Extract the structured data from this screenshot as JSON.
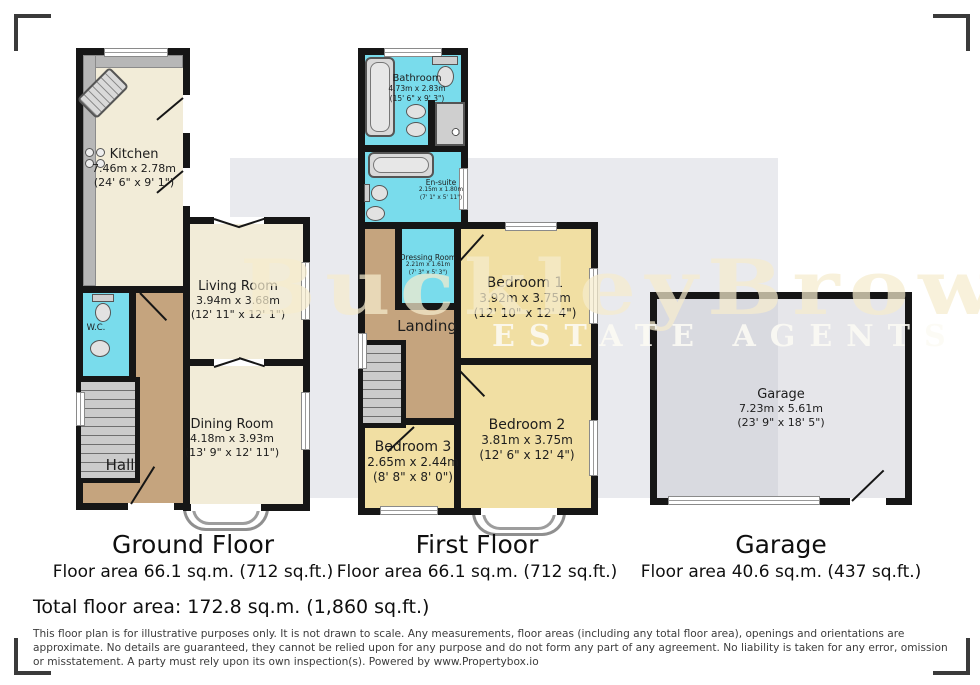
{
  "watermark": {
    "name": "BuckleyBrown",
    "tagline": "ESTATE AGENTS"
  },
  "colors": {
    "wall": "#161616",
    "wet_room": "#79dcec",
    "reception": "#f2ecd8",
    "bedroom": "#f1dfa3",
    "hall": "#c5a47e",
    "garage": "#e4e4e8",
    "watermark_text": "#f0e5c4"
  },
  "rooms": {
    "kitchen": {
      "name": "Kitchen",
      "metric": "7.46m x 2.78m",
      "imperial": "(24' 6\" x 9' 1\")"
    },
    "living": {
      "name": "Living Room",
      "metric": "3.94m x 3.68m",
      "imperial": "(12' 11\" x 12' 1\")"
    },
    "dining": {
      "name": "Dining Room",
      "metric": "4.18m x 3.93m",
      "imperial": "(13' 9\" x 12' 11\")"
    },
    "hall": {
      "name": "Hall"
    },
    "wc": {
      "name": "W.C."
    },
    "bathroom": {
      "name": "Bathroom",
      "metric": "4.73m x 2.83m",
      "imperial": "(15' 6\" x 9' 3\")"
    },
    "ensuite": {
      "name": "En-suite",
      "metric": "2.15m x 1.80m",
      "imperial": "(7' 1\" x 5' 11\")"
    },
    "dressing": {
      "name": "Dressing Room",
      "metric": "2.21m x 1.61m",
      "imperial": "(7' 3\" x 5' 3\")"
    },
    "landing": {
      "name": "Landing"
    },
    "bedroom1": {
      "name": "Bedroom 1",
      "metric": "3.92m x 3.75m",
      "imperial": "(12' 10\" x 12' 4\")"
    },
    "bedroom2": {
      "name": "Bedroom 2",
      "metric": "3.81m x 3.75m",
      "imperial": "(12' 6\" x 12' 4\")"
    },
    "bedroom3": {
      "name": "Bedroom 3",
      "metric": "2.65m x 2.44m",
      "imperial": "(8' 8\" x 8' 0\")"
    },
    "garage": {
      "name": "Garage",
      "metric": "7.23m x 5.61m",
      "imperial": "(23' 9\" x 18' 5\")"
    }
  },
  "floors": {
    "ground": {
      "title": "Ground Floor",
      "area": "Floor area 66.1 sq.m. (712 sq.ft.)"
    },
    "first": {
      "title": "First Floor",
      "area": "Floor area 66.1 sq.m. (712 sq.ft.)"
    },
    "garage": {
      "title": "Garage",
      "area": "Floor area 40.6 sq.m. (437 sq.ft.)"
    }
  },
  "footer": {
    "total": "Total floor area: 172.8 sq.m. (1,860 sq.ft.)",
    "disclaimer": "This floor plan is for illustrative purposes only. It is not drawn to scale. Any measurements, floor areas (including any total floor area), openings and orientations are approximate. No details are guaranteed, they cannot be relied upon for any purpose and do not form any part of any agreement. No liability is taken for any error, omission or misstatement. A party must rely upon its own inspection(s). Powered by www.Propertybox.io"
  }
}
